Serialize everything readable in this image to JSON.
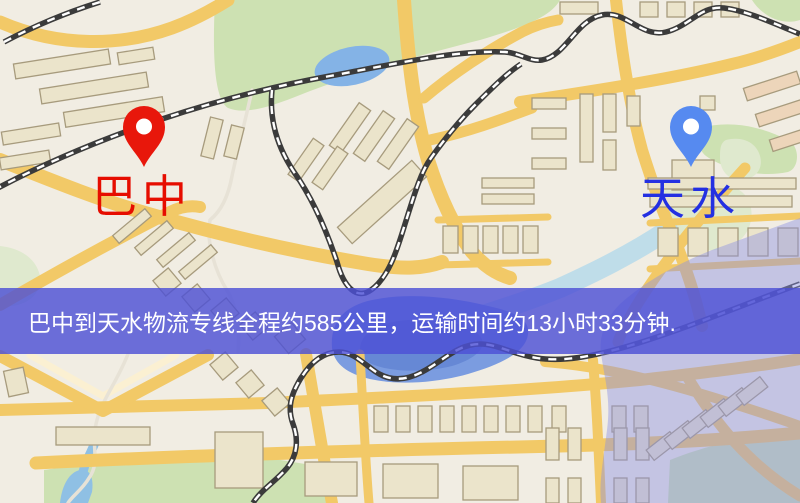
{
  "map": {
    "banner": {
      "text": "巴中到天水物流专线全程约585公里，运输时间约13小时33分钟.",
      "bg": "rgba(77,80,213,0.82)",
      "fg": "#ffffff"
    },
    "origin_marker": {
      "label": "巴中",
      "label_color": "#e60d00",
      "pin_color": "#e8170b"
    },
    "destination_marker": {
      "label": "天水",
      "label_color": "#2430e2",
      "pin_color": "#568af0"
    },
    "palette": {
      "base": "#f1ede3",
      "road": "#f2c967",
      "road_minor": "#fbf0d2",
      "road_white": "#e7e2d6",
      "building": "#ebe4cb",
      "building_stroke": "#a79b7d",
      "building_alt": "#edd5ba",
      "green": "#cde1b2",
      "green_pale": "#dfe9ce",
      "water": "#84b3e6",
      "water_deep": "#7b9ce0",
      "water_core": "#6486d4",
      "river": "#b6d9ea",
      "stream": "#8fc0e4",
      "railway": "#3b3b3b",
      "railway_dash": "#ffffff",
      "overlay": "#8e93e2",
      "pin_hole": "#ffffff"
    }
  }
}
